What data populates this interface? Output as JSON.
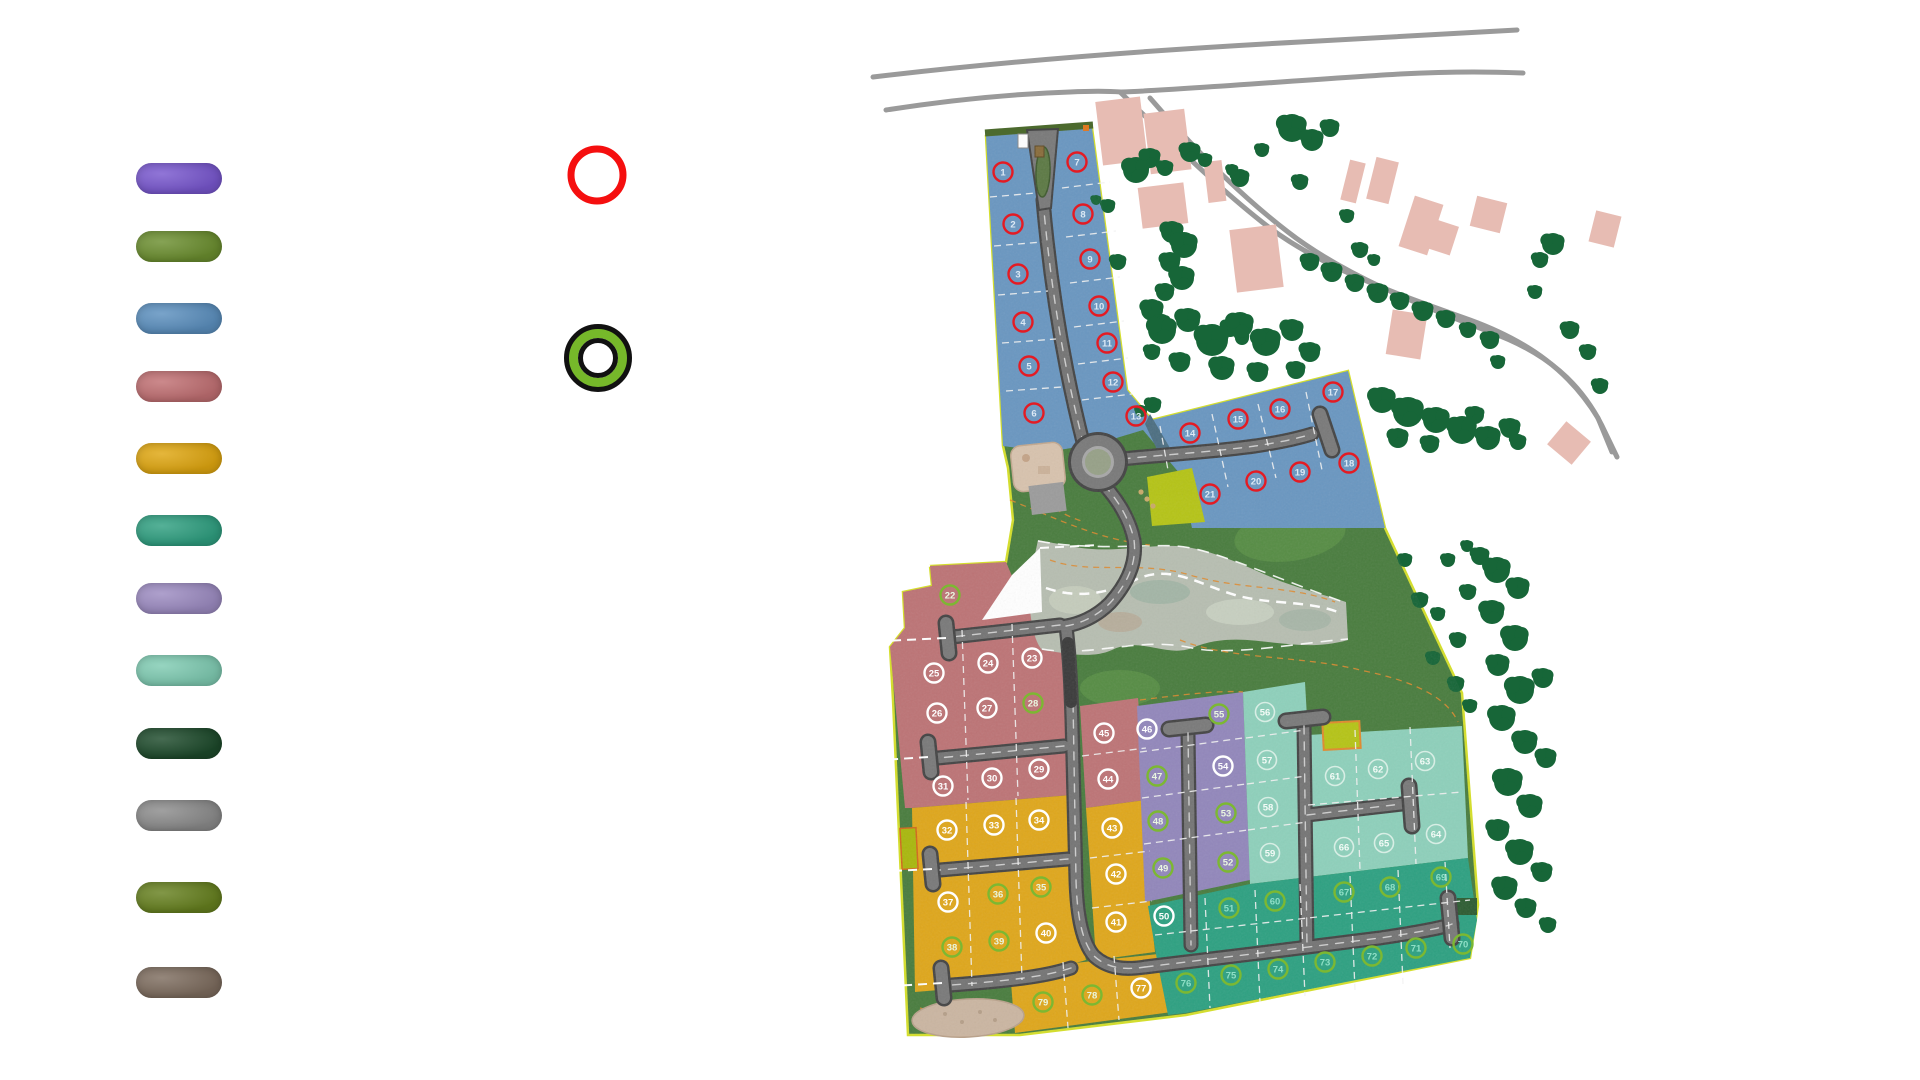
{
  "legend": {
    "swatches": [
      {
        "name": "phase-purple",
        "color": "#7857CE"
      },
      {
        "name": "phase-olive-green",
        "color": "#6B8E2F"
      },
      {
        "name": "phase-blue",
        "color": "#5B8FBE"
      },
      {
        "name": "phase-rose",
        "color": "#C06F72"
      },
      {
        "name": "phase-gold",
        "color": "#DFA610"
      },
      {
        "name": "phase-teal",
        "color": "#2F9F80"
      },
      {
        "name": "phase-lavender",
        "color": "#9C8BC1"
      },
      {
        "name": "phase-mint",
        "color": "#7FCBB2"
      },
      {
        "name": "phase-dark-green",
        "color": "#1D4A2B"
      },
      {
        "name": "phase-gray",
        "color": "#8B8B8B"
      },
      {
        "name": "phase-dark-olive",
        "color": "#66801F"
      },
      {
        "name": "phase-taupe",
        "color": "#7D6C5E"
      }
    ],
    "markers": [
      {
        "name": "available-lot-marker",
        "style": "red-ring",
        "ring_color": "#F50F0F"
      },
      {
        "name": "sold-lot-marker",
        "style": "green-black-ring",
        "ring_color": "#76B82A",
        "outline_color": "#111111"
      }
    ]
  },
  "site_plan": {
    "ring_styles": {
      "red": {
        "stroke": "#E41B23",
        "text": "#DCE9F5"
      },
      "white": {
        "stroke": "#FFFFFF",
        "text": "#FFFFFF"
      },
      "green": {
        "stroke": "#7CB832",
        "text": "#EAF7E0"
      },
      "mint": {
        "stroke": "#E8F5EF",
        "text": "#F4FBF7"
      }
    },
    "phases": [
      {
        "name": "phase-blue",
        "fill": "#6A97C1",
        "default_ring": "red",
        "lots": [
          [
            1,
            1003,
            172
          ],
          [
            2,
            1013,
            224
          ],
          [
            3,
            1018,
            274
          ],
          [
            4,
            1023,
            322
          ],
          [
            5,
            1029,
            366
          ],
          [
            6,
            1034,
            413
          ],
          [
            7,
            1077,
            162
          ],
          [
            8,
            1083,
            214
          ],
          [
            9,
            1090,
            259
          ],
          [
            10,
            1099,
            306
          ],
          [
            11,
            1107,
            343
          ],
          [
            12,
            1113,
            382
          ],
          [
            13,
            1136,
            416
          ],
          [
            14,
            1190,
            433
          ],
          [
            15,
            1238,
            419
          ],
          [
            16,
            1280,
            409
          ],
          [
            17,
            1333,
            392
          ],
          [
            18,
            1349,
            463
          ],
          [
            19,
            1300,
            472
          ],
          [
            20,
            1256,
            481
          ],
          [
            21,
            1210,
            494
          ]
        ]
      },
      {
        "name": "phase-rose",
        "fill": "#BD7476",
        "default_ring": "white",
        "lots": [
          [
            22,
            950,
            595,
            "green"
          ],
          [
            23,
            1032,
            658
          ],
          [
            24,
            988,
            663
          ],
          [
            25,
            934,
            673
          ],
          [
            26,
            937,
            713
          ],
          [
            27,
            987,
            708
          ],
          [
            28,
            1033,
            703,
            "green"
          ],
          [
            29,
            1039,
            769
          ],
          [
            30,
            992,
            778
          ],
          [
            31,
            943,
            786
          ],
          [
            44,
            1108,
            779
          ],
          [
            45,
            1104,
            733
          ]
        ]
      },
      {
        "name": "phase-gold",
        "fill": "#DFA71C",
        "default_ring": "white",
        "lots": [
          [
            32,
            947,
            830
          ],
          [
            33,
            994,
            825
          ],
          [
            34,
            1039,
            820
          ],
          [
            35,
            1041,
            887,
            "green"
          ],
          [
            36,
            998,
            894,
            "green"
          ],
          [
            37,
            948,
            902
          ],
          [
            38,
            952,
            947,
            "green"
          ],
          [
            39,
            999,
            941,
            "green"
          ],
          [
            40,
            1046,
            933
          ],
          [
            41,
            1116,
            922
          ],
          [
            42,
            1116,
            874
          ],
          [
            43,
            1112,
            828
          ],
          [
            77,
            1141,
            988
          ],
          [
            78,
            1092,
            995,
            "green"
          ],
          [
            79,
            1043,
            1002,
            "green"
          ]
        ]
      },
      {
        "name": "phase-lavender",
        "fill": "#9287BB",
        "default_ring": "green",
        "lots": [
          [
            46,
            1147,
            729,
            "white"
          ],
          [
            47,
            1157,
            776
          ],
          [
            48,
            1158,
            821
          ],
          [
            49,
            1163,
            868
          ],
          [
            52,
            1228,
            862
          ],
          [
            53,
            1226,
            813
          ],
          [
            54,
            1223,
            766,
            "white"
          ],
          [
            55,
            1219,
            714
          ]
        ]
      },
      {
        "name": "phase-mint",
        "fill": "#8ED0BB",
        "default_ring": "mint",
        "lots": [
          [
            56,
            1265,
            712
          ],
          [
            57,
            1267,
            760
          ],
          [
            58,
            1268,
            807
          ],
          [
            59,
            1270,
            853
          ],
          [
            61,
            1335,
            776
          ],
          [
            62,
            1378,
            769
          ],
          [
            63,
            1425,
            761
          ],
          [
            64,
            1436,
            834
          ],
          [
            65,
            1384,
            843
          ],
          [
            66,
            1344,
            847
          ]
        ]
      },
      {
        "name": "phase-teal",
        "fill": "#2EA182",
        "default_ring": "green",
        "green_ring_text": "#8FDFC6",
        "lots": [
          [
            50,
            1164,
            916,
            "white"
          ],
          [
            51,
            1229,
            908
          ],
          [
            60,
            1275,
            901
          ],
          [
            67,
            1344,
            892
          ],
          [
            68,
            1390,
            887
          ],
          [
            69,
            1441,
            877
          ],
          [
            70,
            1463,
            944
          ],
          [
            71,
            1416,
            948
          ],
          [
            72,
            1372,
            956
          ],
          [
            73,
            1325,
            962
          ],
          [
            74,
            1278,
            969
          ],
          [
            75,
            1231,
            975
          ],
          [
            76,
            1186,
            983
          ]
        ]
      }
    ],
    "palette": {
      "open_space_green": "#4A7D3F",
      "existing_road_gray": "#9A9A9A",
      "internal_road_gray": "#757575",
      "road_casing": "#454545",
      "building_pink": "#E7BCB3",
      "tree_green": "#176638",
      "stream_gray": "#B7BEB1",
      "site_boundary_yellow": "#D4DE2E",
      "contour_orange": "#E08A2E",
      "amenity_chartreuse": "#B5C417",
      "dirt_tan": "#CBB6A2"
    }
  }
}
